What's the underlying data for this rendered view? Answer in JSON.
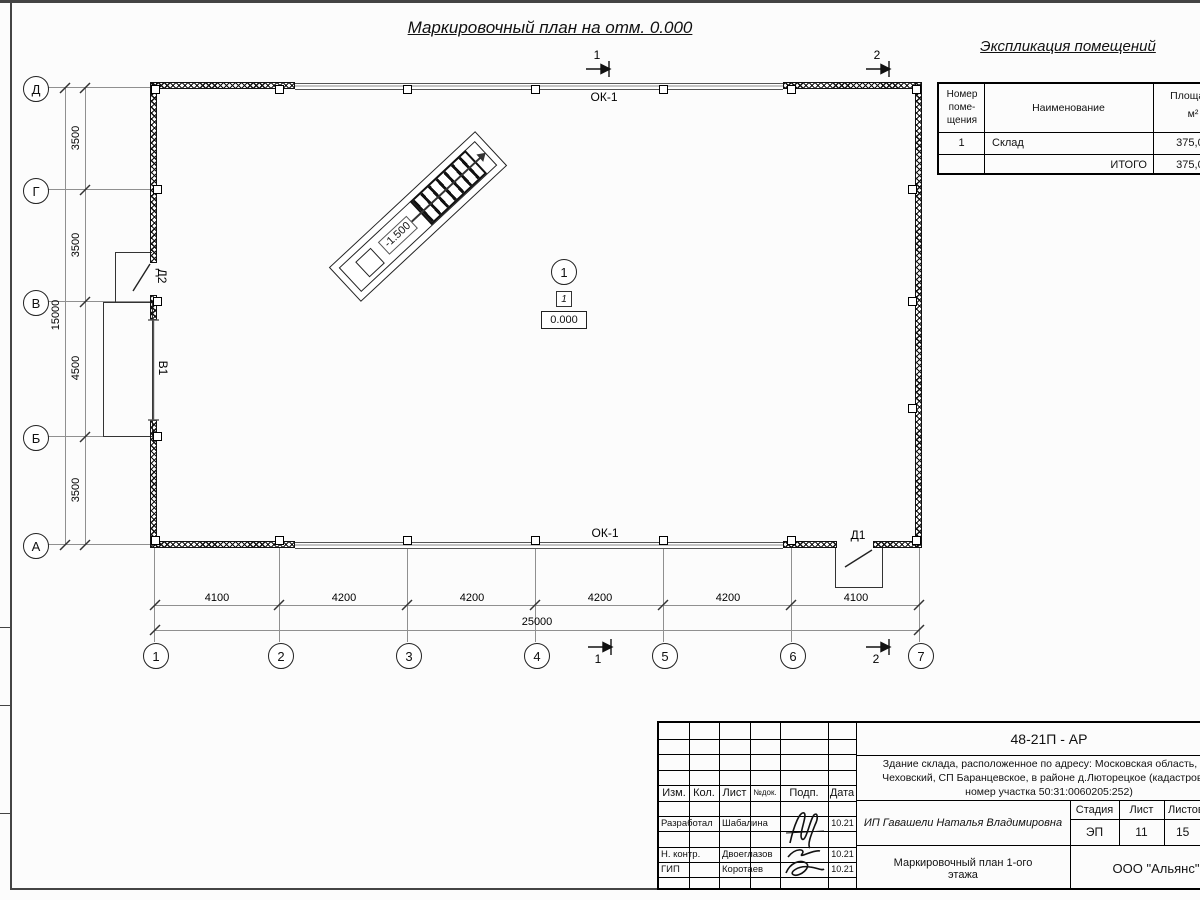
{
  "sheet": {
    "title": "Маркировочный план на отм. 0.000"
  },
  "explication": {
    "title": "Экспликация  помещений",
    "headers": {
      "number": "Номер поме- щения",
      "name": "Наименование",
      "area_line1": "Площадь",
      "area_line2": "м²"
    },
    "rows": [
      {
        "number": "1",
        "name": "Склад",
        "area": "375,00"
      }
    ],
    "total_label": "ИТОГО",
    "total_area": "375,00"
  },
  "plan": {
    "window_label_top": "ОК-1",
    "window_label_bottom": "ОК-1",
    "door1_label": "Д1",
    "door2_label": "Д2",
    "gate_label": "В1",
    "room_circle": "1",
    "floor_type": "1",
    "level_zero": "0.000",
    "ramp_level": "-1.500",
    "section1": "1",
    "section2": "2",
    "axes_rows": [
      "Д",
      "Г",
      "В",
      "Б",
      "А"
    ],
    "axes_cols": [
      "1",
      "2",
      "3",
      "4",
      "5",
      "6",
      "7"
    ],
    "dims_left": [
      "3500",
      "3500",
      "4500",
      "3500"
    ],
    "dim_left_total": "15000",
    "dims_bottom": [
      "4100",
      "4200",
      "4200",
      "4200",
      "4200",
      "4100"
    ],
    "dim_bottom_total": "25000"
  },
  "stamp": {
    "doc_number": "48-21П - АР",
    "description_lines": [
      "Здание склада, расположенное по адресу: Московская область, р-н",
      "Чеховский, СП Баранцевское, в районе д.Люторецкое  (кадастровый",
      "номер участка 50:31:0060205:252)"
    ],
    "cols": {
      "izm": "Изм.",
      "kol": "Кол.",
      "list": "Лист",
      "ndok": "№док.",
      "podp": "Подп.",
      "data": "Дата"
    },
    "roles": [
      {
        "role": "Разработал",
        "name": "Шабалина",
        "date": "10.21"
      },
      {
        "role": "Н. контр.",
        "name": "Двоеглазов",
        "date": "10.21"
      },
      {
        "role": "ГИП",
        "name": "Коротаев",
        "date": "10.21"
      }
    ],
    "client": "ИП Гавашели Наталья Владимировна",
    "stage_label": "Стадия",
    "sheet_label": "Лист",
    "sheets_label": "Листов",
    "stage": "ЭП",
    "sheet_no": "11",
    "sheets_total": "15",
    "drawing_name": "Маркировочный план 1-ого этажа",
    "company": "ООО \"Альянс\""
  }
}
